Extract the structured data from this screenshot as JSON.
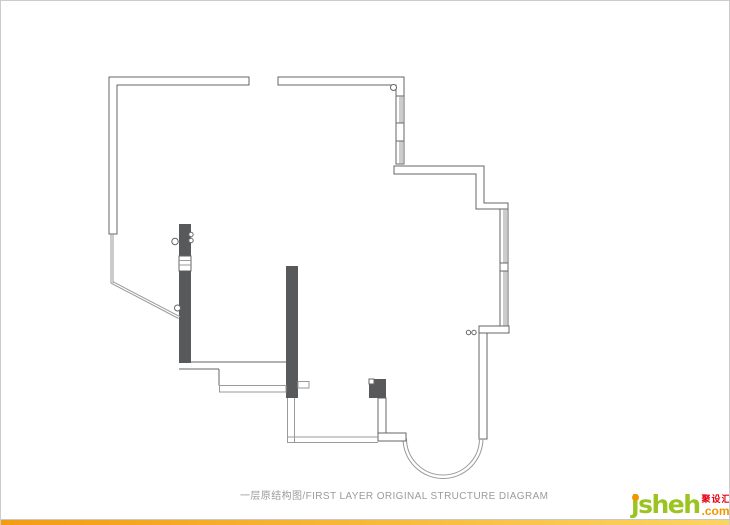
{
  "page": {
    "caption": "一层原结构图/FIRST LAYER ORIGINAL STRUCTURE DIAGRAM"
  },
  "logo": {
    "name": "jsheh",
    "tld": ".com",
    "cjk": "聚设汇"
  },
  "colors": {
    "wall-stroke": "#666666",
    "thin-line": "#9a9a9a",
    "column-fill": "#58595b",
    "caption": "#9b9b9b",
    "logo-green": "#9bc420",
    "logo-orange": "#f29600",
    "logo-red": "#e60012",
    "divider": "#c8c8c8",
    "bar-start": "#f39c11",
    "bar-end": "#fbd560",
    "background": "#ffffff",
    "border": "#cccccc"
  }
}
